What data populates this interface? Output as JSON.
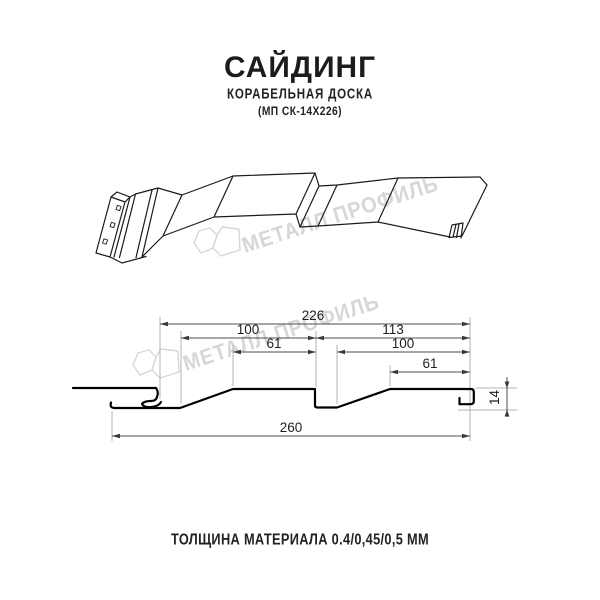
{
  "page": {
    "background": "#ffffff"
  },
  "header": {
    "title": "САЙДИНГ",
    "subtitle": "КОРАБЕЛЬНАЯ ДОСКА",
    "product_code": "(МП СК-14Х226)"
  },
  "watermark": {
    "brand": "МЕТАЛЛ ПРОФИЛЬ",
    "color": "#d7d7d7"
  },
  "cross_section": {
    "dimensions": {
      "useful_width": "226",
      "board1_width": "100",
      "board2_width": "113",
      "board1_flat": "61",
      "board2_width_inner": "100",
      "board2_flat": "61",
      "profile_height": "14",
      "overall_width": "260"
    }
  },
  "footer": {
    "thickness_note": "ТОЛЩИНА МАТЕРИАЛА 0.4/0,45/0,5 ММ"
  },
  "colors": {
    "line": "#1a1a1a",
    "dimension_line": "#4d4d4d",
    "extension_line": "#b3b3b3",
    "text": "#1f1f1f"
  }
}
